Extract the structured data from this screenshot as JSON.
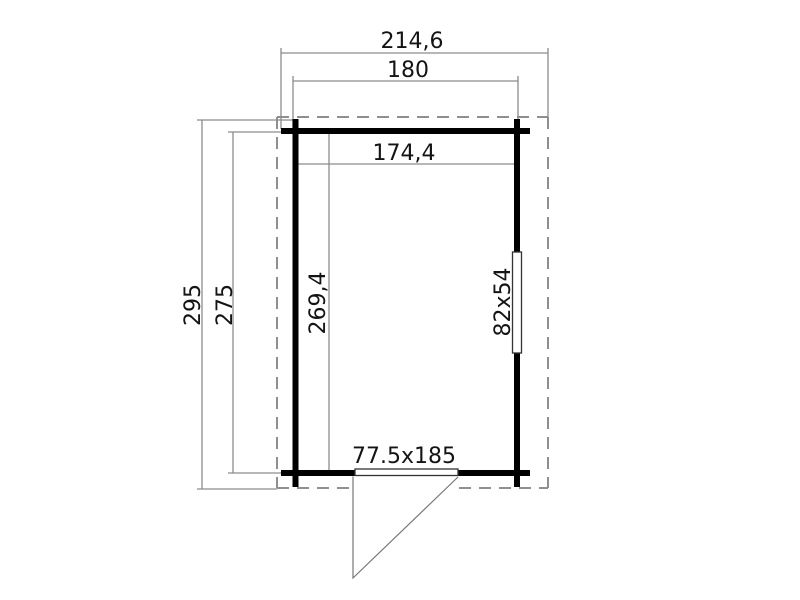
{
  "diagram": {
    "type": "floor-plan",
    "description": "Technical plan drawing of a cabin: outer roof outline (dashed), log walls, one window opening on the right wall and one door opening with outward swing at the bottom wall",
    "dimensions": {
      "overall_width": "214,6",
      "wall_width": "180",
      "inner_width": "174,4",
      "overall_depth": "295",
      "wall_depth": "275",
      "inner_depth": "269,4",
      "window_size": "82x54",
      "door_size": "77.5x185"
    },
    "colors": {
      "background": "#ffffff",
      "wall": "#000000",
      "dimension_line": "#8c8c8c",
      "overhang_dash": "#8f8f8f",
      "label_text": "#141414"
    }
  }
}
